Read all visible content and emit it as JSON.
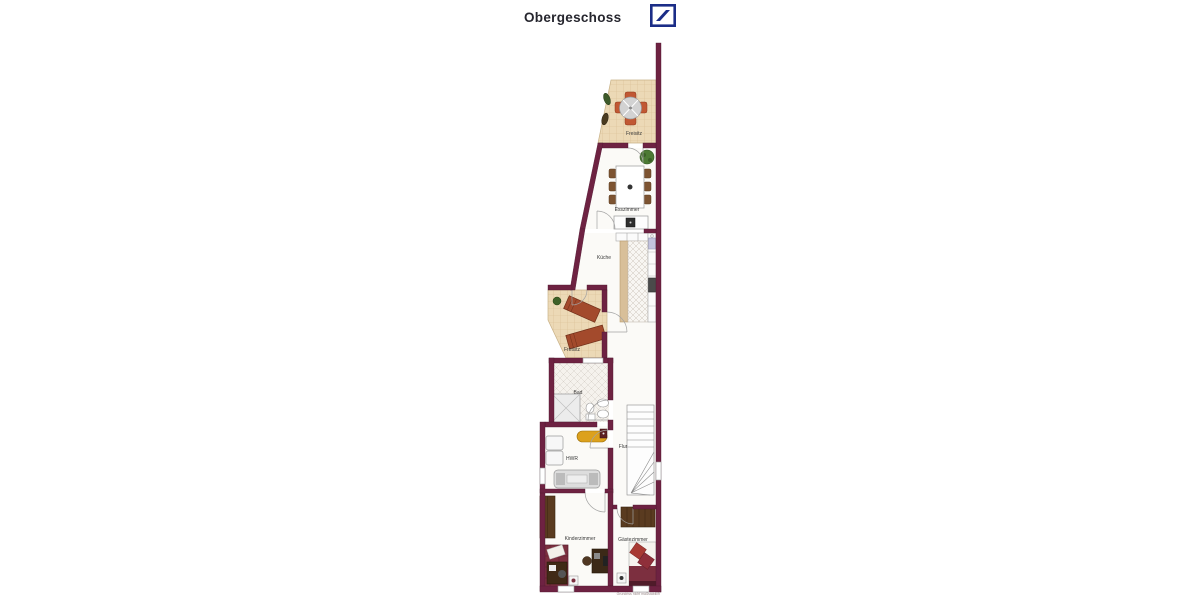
{
  "header": {
    "title": "Obergeschoss"
  },
  "logo": {
    "name": "deutsche-bank-logo",
    "color": "#1b2d87"
  },
  "floorplan": {
    "wall_color": "#6e2242",
    "terrace_tile_color": "#ecd9b6",
    "accent_chair_color": "#c15833",
    "rooms": {
      "freisitz_top": "Freisitz",
      "esszimmer": "Esszimmer",
      "kueche": "Küche",
      "freisitz_lower": "Freisitz",
      "bad": "Bad",
      "hwr": "HWR",
      "flur": "Flur",
      "kinderzimmer": "Kinderzimmer",
      "gaestezimmer": "Gästezimmer"
    },
    "footnote": "Grundriss nicht maßstäblich"
  }
}
